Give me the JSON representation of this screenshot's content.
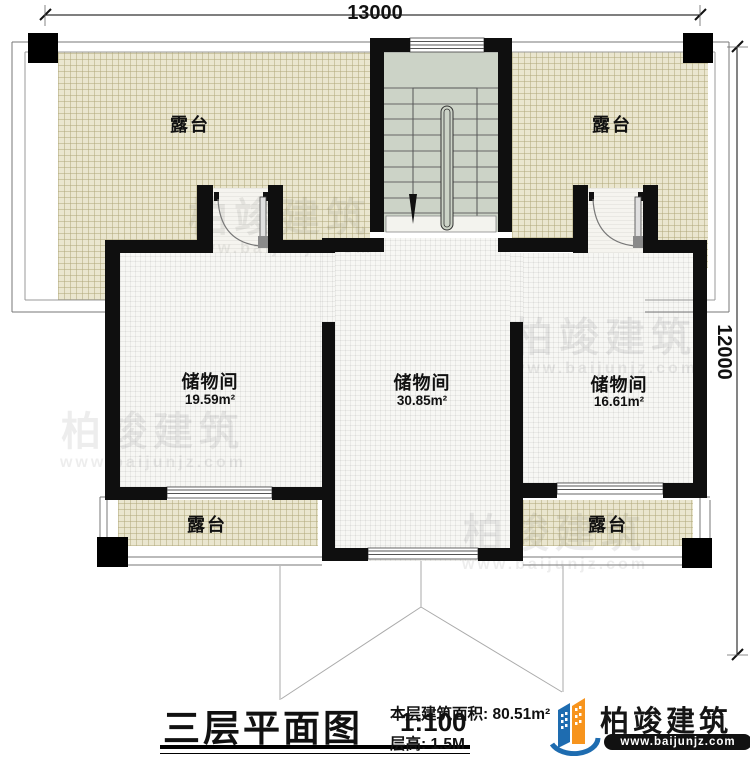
{
  "plan": {
    "title": "三层平面图",
    "scale": "1:100",
    "area_label": "本层建筑面积:",
    "area_value": "80.51m²",
    "height_label": "层高:",
    "height_value": "1.5M"
  },
  "dimensions": {
    "top": "13000",
    "right": "12000"
  },
  "rooms": [
    {
      "name": "储物间",
      "area": "19.59m²"
    },
    {
      "name": "储物间",
      "area": "30.85m²"
    },
    {
      "name": "储物间",
      "area": "16.61m²"
    }
  ],
  "terraces": [
    {
      "name": "露台"
    },
    {
      "name": "露台"
    },
    {
      "name": "露台"
    },
    {
      "name": "露台"
    }
  ],
  "stair": {
    "direction": "down-arrow"
  },
  "logo": {
    "name": "柏竣建筑",
    "website": "www.baijunjz.com"
  },
  "watermark": {
    "text": "柏竣建筑",
    "website": "www.baijunjz.com"
  },
  "colors": {
    "terrace_fill": "#eae6cf",
    "floor_fill": "#f7f7f4",
    "stair_fill": "#ccd3c7",
    "wall": "#0f0f0f",
    "logo_blue": "#1e6cb0",
    "logo_orange": "#f7941d"
  }
}
